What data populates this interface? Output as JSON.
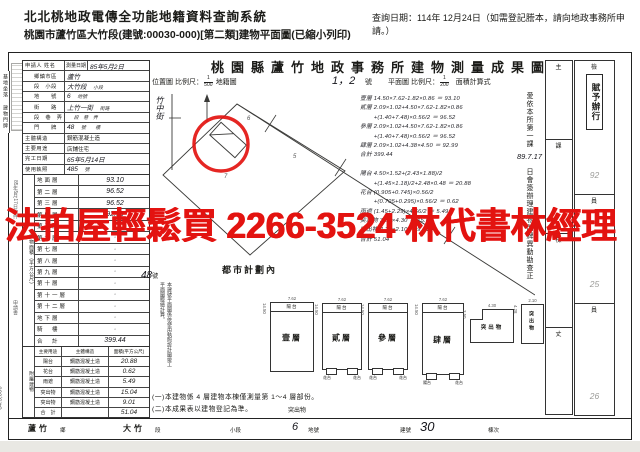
{
  "header": {
    "system_title": "北北桃地政電傳全功能地籍資料查詢系統",
    "query_date": "查詢日期：114年 12月24日（如需登記謄本，請向地政事務所申請。）",
    "subtitle": "桃園市蘆竹區大竹段(建號:00030-000)[第二類]建物平面圖(已縮小列印)"
  },
  "watermark": {
    "text": "法拍屋輕鬆買 2266-3524 林代書林經理",
    "color": "#e31310"
  },
  "doc": {
    "title": "桃園縣蘆竹地政事務所建物測量成果圖",
    "scale_row": {
      "location_map": "位置圖",
      "scale_label": "比例尺：",
      "scale1": [
        "1",
        "500"
      ],
      "cadastral": "地籍圖",
      "sheet": "1，2",
      "sheet_suffix": "號",
      "plan": "平面圖",
      "scale2": [
        "1",
        "200"
      ],
      "calc": "面積計算式"
    },
    "groups": [
      "基地坐落",
      "建物門牌"
    ],
    "info_rows": [
      {
        "label": "申請人 姓名",
        "mid": "測量日期",
        "value": "85年5月2日",
        "suffix": "",
        "hand": true
      },
      {
        "label": "鄉鎮市區",
        "value": "蘆竹",
        "suffix": "",
        "hand": true
      },
      {
        "label": "段　小段",
        "value": "大竹段",
        "suffix": "小段",
        "hand": true
      },
      {
        "label": "地　　號",
        "value": "6",
        "suffix": "地號",
        "hand": true
      },
      {
        "label": "街　　路",
        "value": "上竹一街",
        "suffix": "街路",
        "hand": true
      },
      {
        "label": "段　巷　弄",
        "value": "",
        "suffix": "段　巷　弄",
        "hand": true
      },
      {
        "label": "門　　牌",
        "value": "48",
        "suffix": "號　　樓",
        "hand": true
      },
      {
        "label": "主體構造",
        "value": "鋼筋混凝土造",
        "suffix": "",
        "hand": false
      },
      {
        "label": "主要用途",
        "value": "店鋪住宅",
        "suffix": "",
        "hand": false
      },
      {
        "label": "完工日期",
        "value": "65年5月14日",
        "suffix": "",
        "hand": true
      },
      {
        "label": "使用執照",
        "value": "485",
        "suffix": "號",
        "hand": true
      }
    ],
    "floor_col_label": "建物面積（平方公尺）",
    "floor_rows": [
      [
        "地面層",
        "93.10"
      ],
      [
        "第二層",
        "96.52"
      ],
      [
        "第三層",
        "96.52"
      ],
      [
        "第四層",
        "92.99"
      ],
      [
        "第五層",
        "·"
      ],
      [
        "第六層",
        "·"
      ],
      [
        "第七層",
        "·"
      ],
      [
        "第八層",
        "·"
      ],
      [
        "第九層",
        "·"
      ],
      [
        "第十層",
        "·"
      ],
      [
        "第十一層",
        "·"
      ],
      [
        "第十二層",
        "·"
      ],
      [
        "地下層",
        "·"
      ],
      [
        "騎　樓",
        "·"
      ],
      [
        "合　計",
        "399.44"
      ]
    ],
    "attached_col_label": "附屬建物",
    "attached_header": [
      "主要用途",
      "主體構造",
      "面積(平方公尺)"
    ],
    "attached_rows": [
      [
        "陽台",
        "鋼筋混凝土造",
        "20.88"
      ],
      [
        "花台",
        "鋼筋混凝土造",
        "0.62"
      ],
      [
        "雨遮",
        "鋼筋混凝土造",
        "5.49"
      ],
      [
        "突出物",
        "鋼筋混凝土造",
        "15.04"
      ],
      [
        "突出物",
        "鋼筋混凝土造",
        "9.01"
      ],
      [
        "合　計",
        "",
        "51.04"
      ]
    ],
    "map": {
      "street": "竹中街",
      "zone": "都市計劃內",
      "house_no": "48",
      "house_no_suffix": "號",
      "note": "本建號平面圖係依使用執照設計圖竣工平面圖謄繪計算。",
      "marks": [
        "6",
        "7",
        "5"
      ]
    },
    "calc_lines": [
      "壹層 14.50×7.62-1.82×0.86 ＝ 93.10",
      "貳層 2.09×1.02+4.50×7.62-1.82×0.86",
      "　　 +(1.40+7.48)×0.56/2 ＝ 96.52",
      "參層 2.09×1.02+4.50×7.62-1.82×0.86",
      "　　 +(1.40+7.48)×0.56/2 ＝ 96.52",
      "肆層 2.09×1.02+4.38×4.50 ＝ 92.99",
      "合計 399.44",
      "",
      "陽台 4.50×1.52+(2.43×1.88)/2",
      "　　 +(1.45×1.18)/2+2.48×0.48 ＝ 20.88",
      "花台 (0.905+0.745)×0.56/2",
      "　　 +(0.705+0.295)×0.56/2 ＝ 0.62",
      "雨遮 (1.45+2.29)×4.56/2 ＝ 5.49",
      "突出物 3.50×4.30 ＝ 15.04",
      "突出物 4.28×2.10 ＝ 9.01",
      "合計 51.04"
    ],
    "annotation": {
      "pre": "愛依本所第一課",
      "date": "89.7.17",
      "post": "日會簽辦理建物門牌異動勘查正"
    },
    "plans": [
      {
        "label": "壹層",
        "top_label": "陽台",
        "dim_top": "7.62",
        "dim_side": "14.50",
        "tabs": []
      },
      {
        "label": "貳層",
        "top_label": "陽台",
        "dim_top": "7.62",
        "dim_side": "14.50",
        "tabs": [
          "花台",
          "花台"
        ]
      },
      {
        "label": "參層",
        "top_label": "陽台",
        "dim_top": "7.62",
        "dim_side": "14.50",
        "tabs": [
          "花台",
          "花台"
        ]
      },
      {
        "label": "肆層",
        "top_label": "陽台",
        "dim_top": "7.62",
        "dim_side": "14.50",
        "tabs": [
          "陽台",
          "花台"
        ]
      },
      {
        "label": "突出物",
        "top_label": "",
        "dim_top": "4.30",
        "dim_side": "3.50",
        "tabs": []
      },
      {
        "label": "突出物",
        "top_label": "",
        "dim_top": "2.10",
        "dim_side": "4.28",
        "tabs": []
      }
    ],
    "notes": {
      "line1": "(一)本建物係 4 層建物本棟僅測量第 1～4 層部份。",
      "line2": "(二)本成果表以建物登記為準。",
      "extra": "突出物"
    },
    "signoff": {
      "colA": [
        "主",
        "課",
        "檢",
        "丈"
      ],
      "colB": [
        "檢",
        "員",
        "員"
      ],
      "stamp": "賦予辦行",
      "marks": [
        "92",
        "25",
        "26"
      ]
    },
    "bottom_strip": {
      "town": "蘆竹",
      "town_suffix": "鄉",
      "section": "大竹",
      "section_suffix": "段",
      "subsection": "小段",
      "parcel": "6",
      "parcel_suffix": "地號",
      "building_label": "建號",
      "building_no": "30",
      "unit": "棟次"
    },
    "margin": {
      "received": "85年5月17日收件",
      "application": "申請書",
      "form_code": "84.5,000"
    }
  }
}
